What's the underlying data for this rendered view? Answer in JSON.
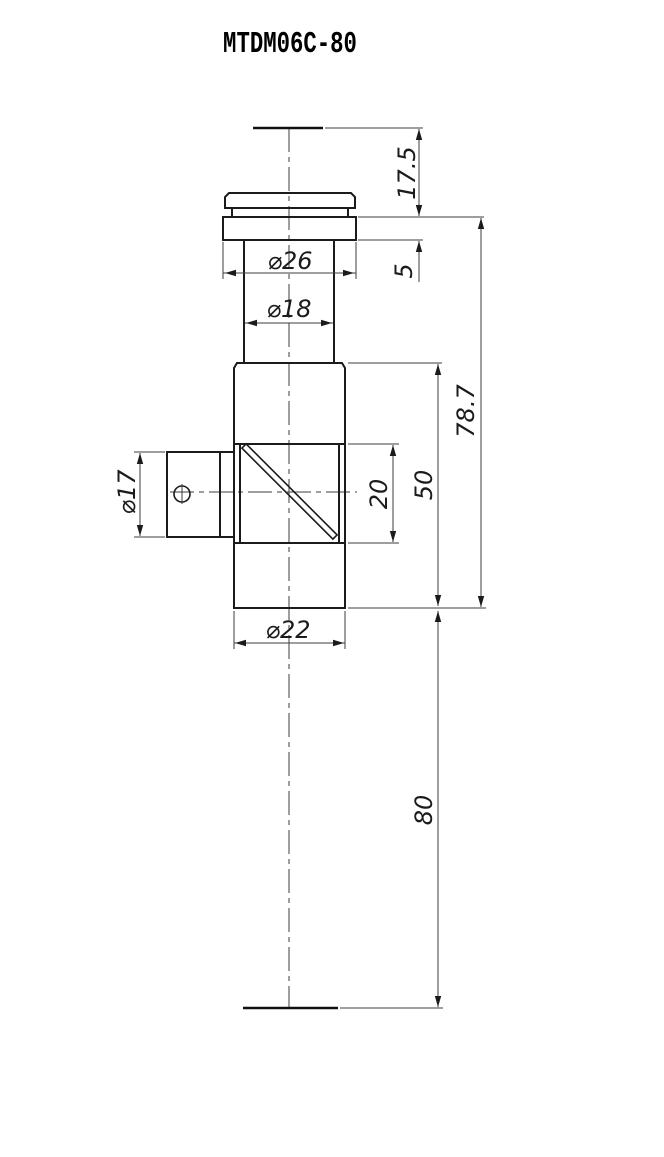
{
  "title": "MTDM06C-80",
  "dimensions": {
    "top_section_height": "17.5",
    "flange_thickness": "5",
    "flange_diameter": "⌀26",
    "upper_body_diameter": "⌀18",
    "overall_body_height": "78.7",
    "block_height": "50",
    "window_height": "20",
    "side_port_diameter": "⌀17",
    "block_diameter": "⌀22",
    "lower_extension_length": "80"
  }
}
